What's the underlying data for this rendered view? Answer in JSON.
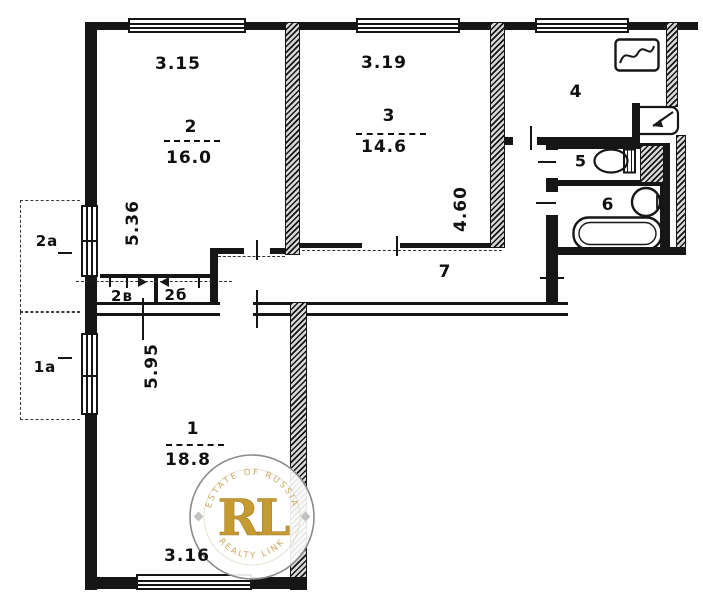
{
  "plan": {
    "room1": {
      "number": "1",
      "area": "18.8",
      "dim_bottom": "3.16",
      "dim_left": "5.95"
    },
    "room2": {
      "number": "2",
      "area": "16.0",
      "dim_top": "3.15",
      "dim_left": "5.36"
    },
    "room3": {
      "number": "3",
      "area": "14.6",
      "dim_top": "3.19",
      "dim_right": "4.60"
    },
    "kitchen": {
      "number": "4"
    },
    "wc": {
      "number": "5"
    },
    "bathroom": {
      "number": "6"
    },
    "corridor": {
      "number": "7"
    },
    "balcony_upper": {
      "label": "2а"
    },
    "balcony_lower": {
      "label": "1а"
    },
    "closet_left": {
      "label": "2в"
    },
    "closet_right": {
      "label": "2б"
    }
  },
  "watermark": {
    "initials": "RL",
    "arc_top": "ESTATE OF RUSSIA",
    "arc_bottom": "REALTY LINK",
    "accent_color": "#c59a33"
  },
  "colors": {
    "ink": "#161616",
    "paper": "#ffffff"
  }
}
